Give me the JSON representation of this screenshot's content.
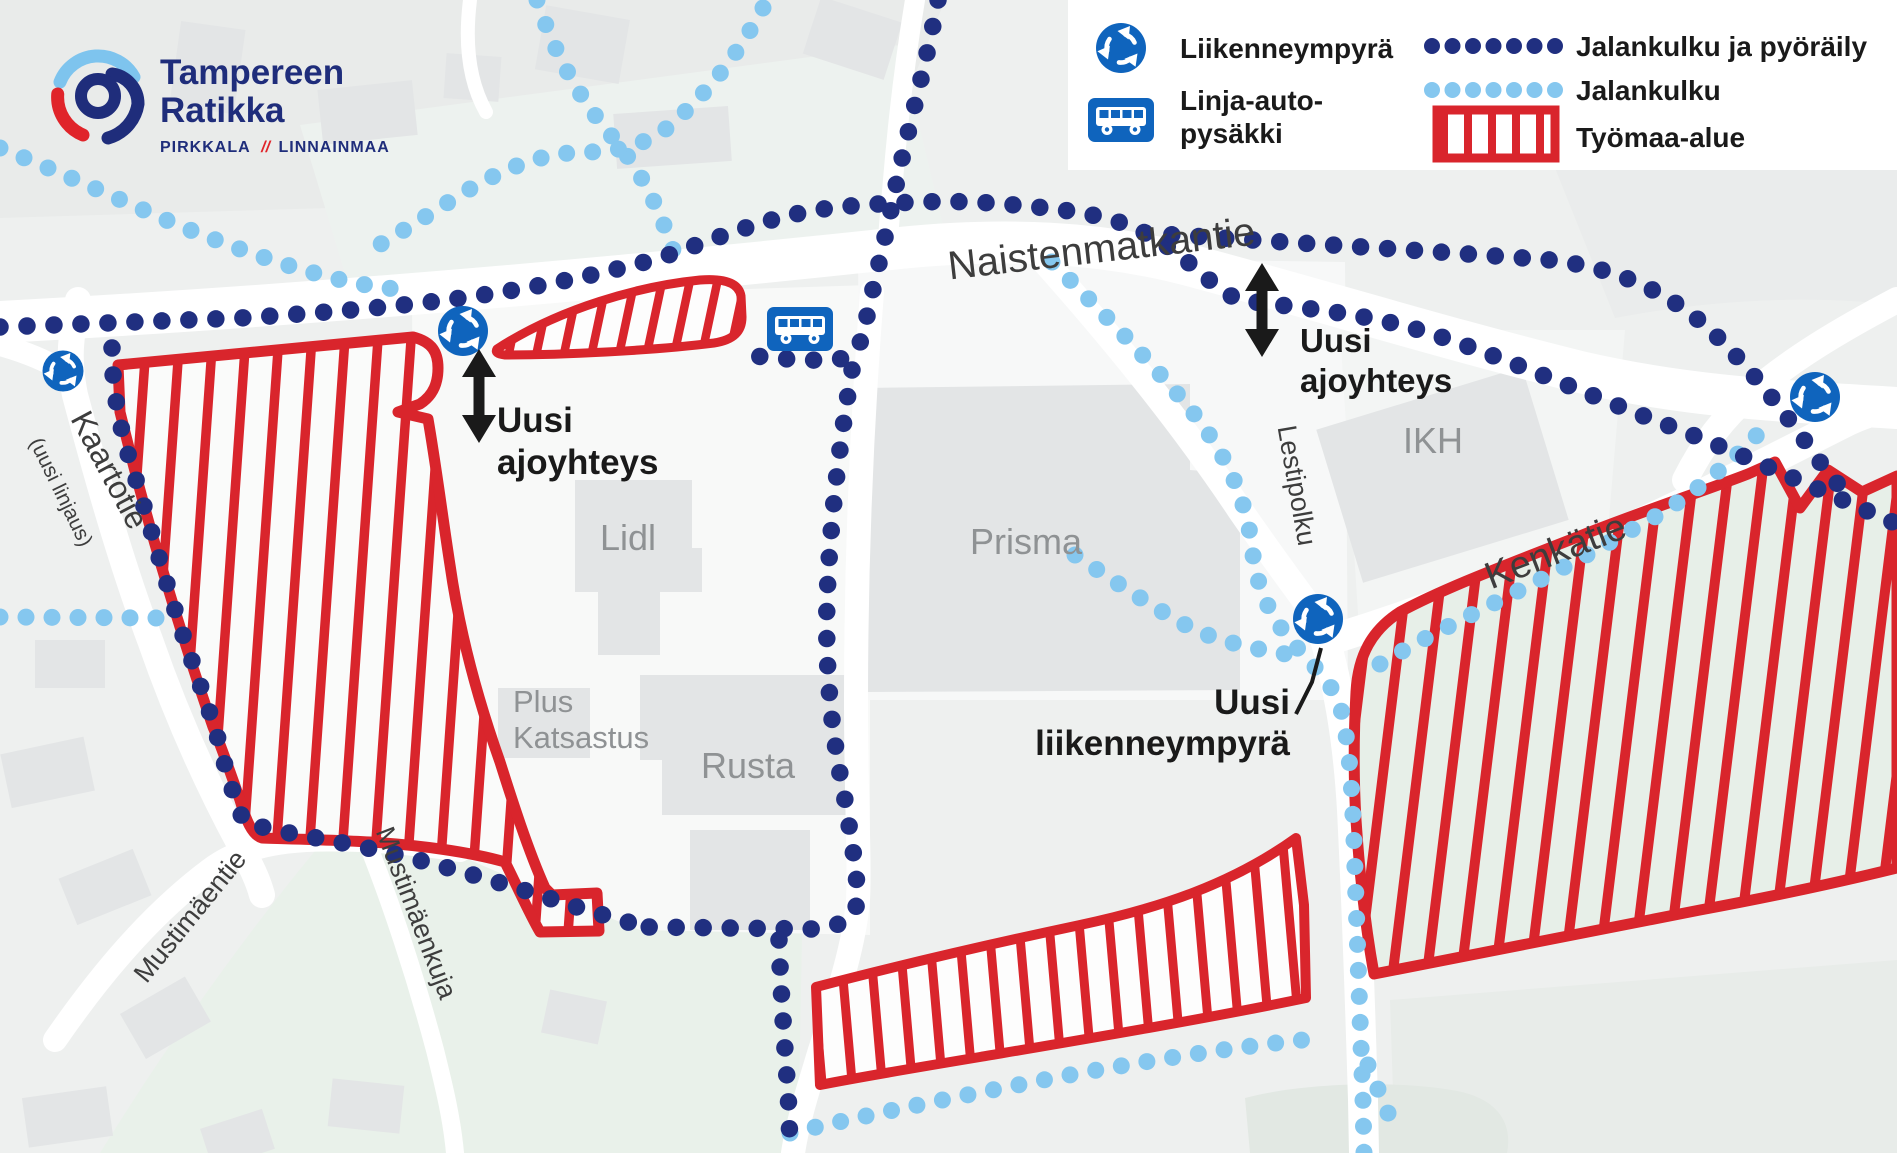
{
  "logo": {
    "title_line1": "Tampereen",
    "title_line2": "Ratikka",
    "tagline_left": "PIRKKALA",
    "tagline_sep": "//",
    "tagline_right": "LINNAINMAA"
  },
  "legend": {
    "roundabout_label": "Liikenneympyrä",
    "bus_stop_line1": "Linja-auto-",
    "bus_stop_line2": "pysäkki",
    "walk_cycle_label": "Jalankulku ja pyöräily",
    "walk_label": "Jalankulku",
    "work_area_label": "Työmaa-alue"
  },
  "map": {
    "streets": {
      "naistenmatkantie": "Naistenmatkantie",
      "kaartotie": "Kaartotie",
      "kaartotie_note": "(uusi linjaus)",
      "mustimaentie": "Mustimäentie",
      "mustimaenkuja": "Mustimäenkuja",
      "lestipolku": "Lestipolku",
      "kenkatie": "Kenkätie"
    },
    "buildings": {
      "lidl": "Lidl",
      "prisma": "Prisma",
      "rusta": "Rusta",
      "plus_katsastus_line1": "Plus",
      "plus_katsastus_line2": "Katsastus",
      "ikh": "IKH"
    },
    "annotations": {
      "new_access_west_line1": "Uusi",
      "new_access_west_line2": "ajoyhteys",
      "new_access_east_line1": "Uusi",
      "new_access_east_line2": "ajoyhteys",
      "new_roundabout_line1": "Uusi",
      "new_roundabout_line2": "liikenneympyrä"
    }
  },
  "colors": {
    "background": "#eef0ef",
    "road": "#ffffff",
    "building": "#e3e5e6",
    "green_area": "#e9f1ea",
    "walk_cycle_route": "#202f80",
    "walk_route": "#85c7ef",
    "work_area_red": "#d9252c",
    "sign_blue": "#0f64bd",
    "annotation_black": "#1a1a1a",
    "logo_navy": "#1f2d7b",
    "logo_red": "#e0242a",
    "logo_lightblue": "#7ec4ee"
  }
}
